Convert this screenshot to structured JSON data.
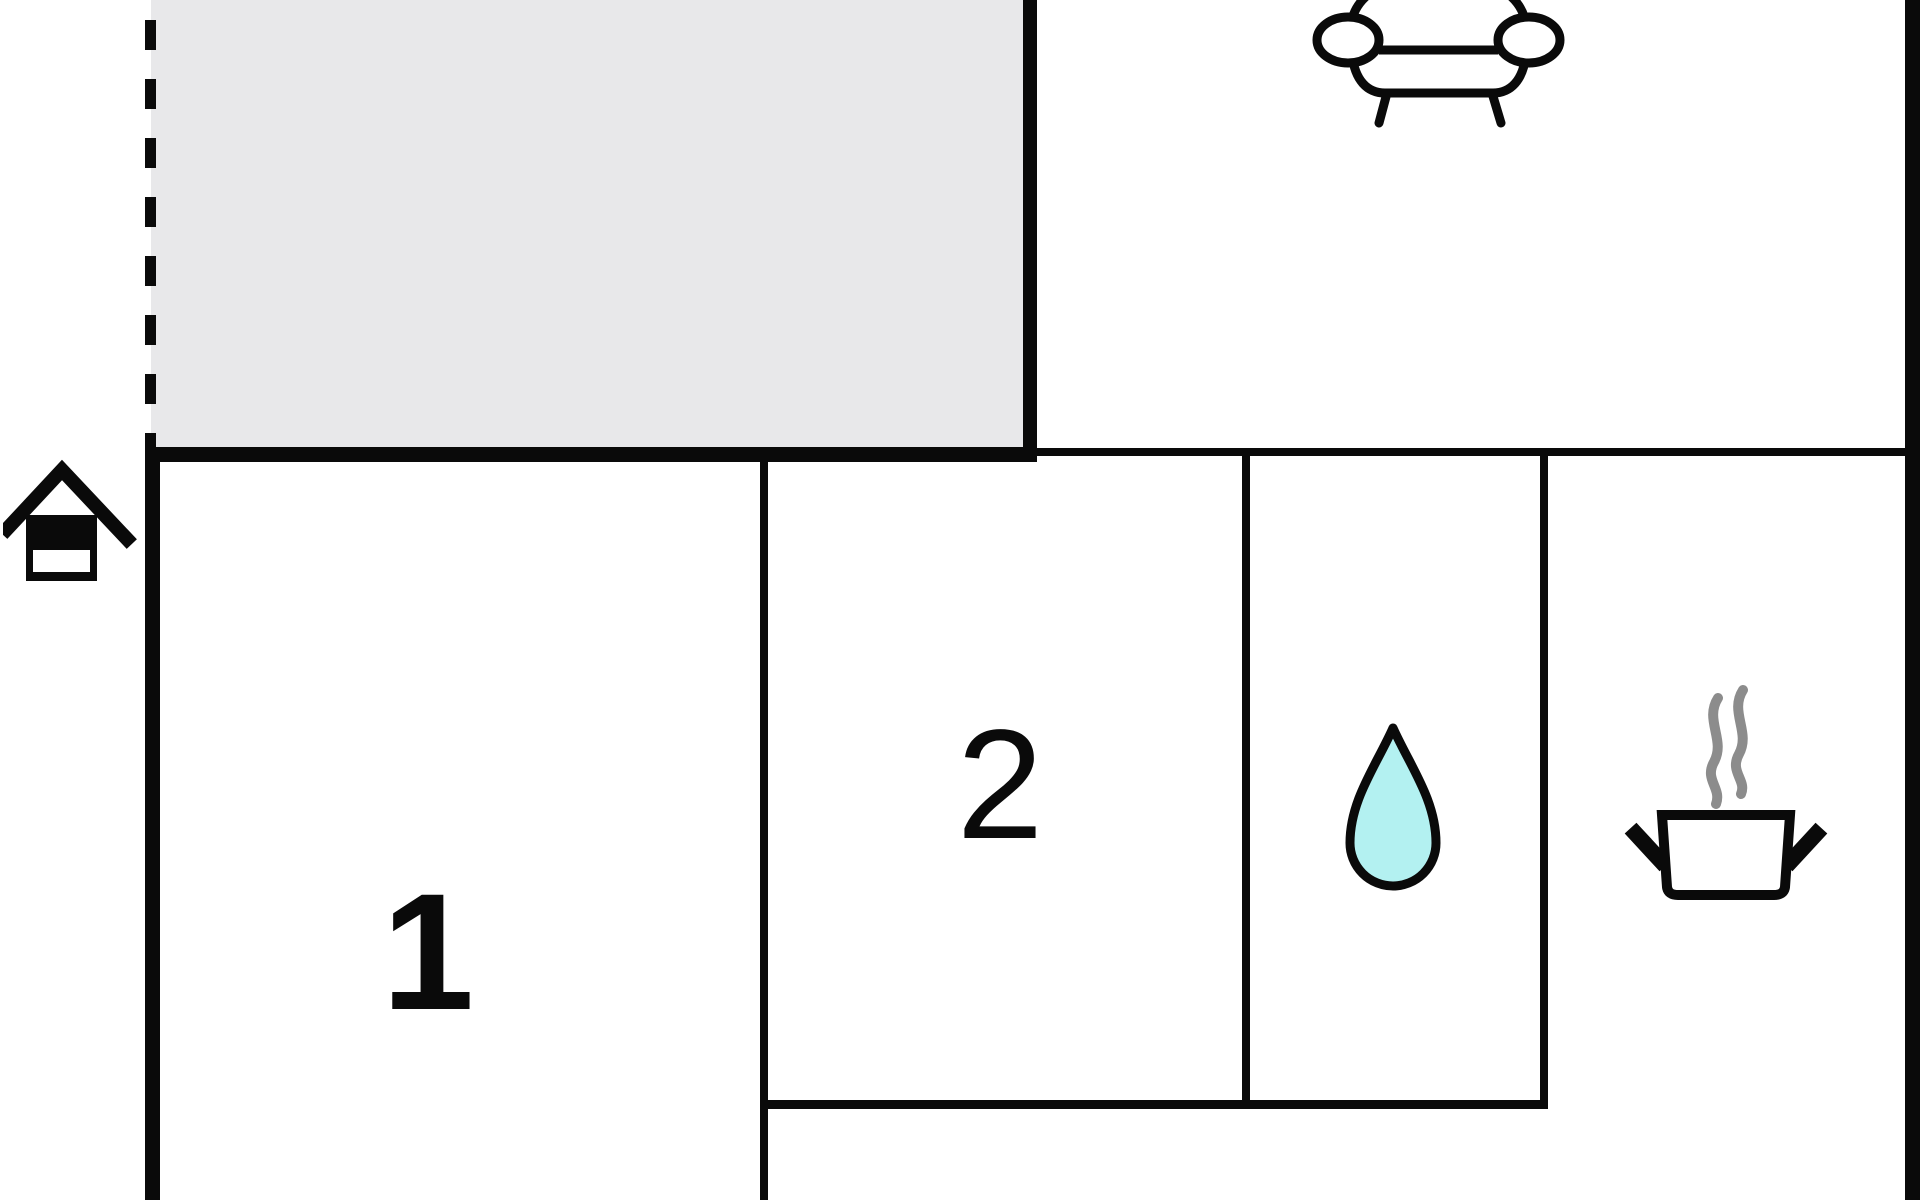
{
  "plan": {
    "type": "apartment floor plan",
    "rooms": {
      "terrace": {
        "name": "terrace",
        "fill": "#e8e8ea",
        "boundary": "dashed open edge on left"
      },
      "room1": {
        "label": "1"
      },
      "room2": {
        "label": "2"
      },
      "bathroom": {
        "icon": "water-drop-icon"
      },
      "kitchen": {
        "icon": "cooking-pot-icon"
      },
      "living_area": {
        "icon": "sofa-icon"
      }
    },
    "entrance_marker": {
      "icon": "house-icon",
      "position": "outside left wall"
    }
  },
  "colors": {
    "wall": "#0a0a0a",
    "terrace_fill": "#e8e8ea",
    "drop_fill": "#b3f1f1",
    "drop_stroke": "#0a0a0a",
    "steam_stroke": "#8c8c8c",
    "icon_stroke": "#0a0a0a",
    "background": "#ffffff"
  },
  "icons": {
    "house": "house-icon",
    "sofa": "sofa-icon",
    "water_drop": "water-drop-icon",
    "cooking_pot": "cooking-pot-icon"
  }
}
